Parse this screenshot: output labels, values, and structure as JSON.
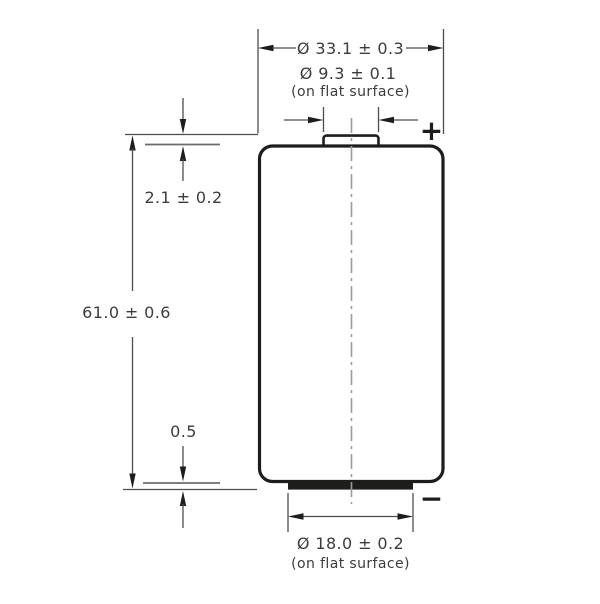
{
  "drawing": {
    "type": "battery-outline-dimension-drawing",
    "labels": {
      "overall_diameter": "Ø 33.1 ± 0.3",
      "pos_terminal_diameter": "Ø 9.3 ± 0.1",
      "pos_terminal_note": "(on flat surface)",
      "pos_terminal_height": "2.1 ± 0.2",
      "overall_height": "61.0 ± 0.6",
      "neg_terminal_protrusion": "0.5",
      "neg_terminal_diameter": "Ø 18.0 ± 0.2",
      "neg_terminal_note": "(on flat surface)",
      "positive_symbol": "+",
      "negative_symbol": "−"
    },
    "colors": {
      "background": "#ffffff",
      "body_outline": "#1d1d1b",
      "dimension_lines": "#4d4d4d",
      "reference_edges": "#6b6b6b",
      "center_line": "#9b9b9b",
      "text": "#3c3c3b"
    }
  }
}
